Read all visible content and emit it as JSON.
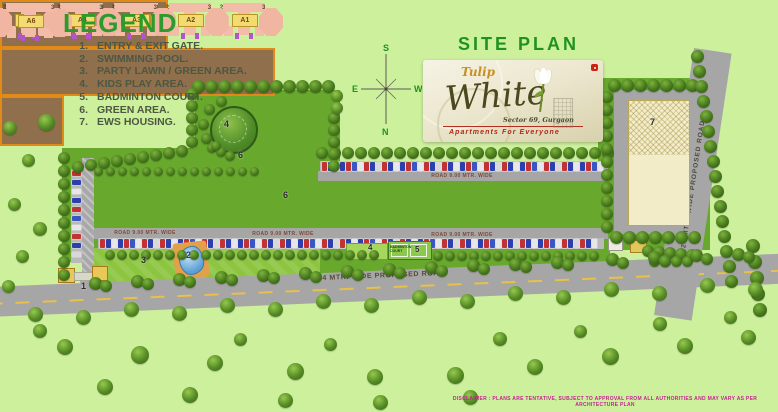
{
  "legend": {
    "title": "LEGEND",
    "items": [
      {
        "num": "1.",
        "label": "ENTRY & EXIT GATE."
      },
      {
        "num": "2.",
        "label": "SWIMMING POOL."
      },
      {
        "num": "3.",
        "label": "PARTY LAWN / GREEN AREA."
      },
      {
        "num": "4.",
        "label": "KIDS PLAY AREA."
      },
      {
        "num": "5.",
        "label": "BADMINTON COURT."
      },
      {
        "num": "6.",
        "label": "GREEN AREA."
      },
      {
        "num": "7.",
        "label": "EWS HOUSING."
      }
    ]
  },
  "header": {
    "site_plan_title": "SITE PLAN"
  },
  "compass": {
    "north": "N",
    "south": "S",
    "east": "E",
    "west": "W"
  },
  "logo": {
    "brand": "Tulip",
    "name": "White",
    "location": "Sector 69, Gurgaon",
    "tagline": "Apartments  For  Everyone"
  },
  "map": {
    "towers_left": [
      "A9",
      "A8",
      "A7"
    ],
    "towers_right": [
      "A5",
      "A4",
      "A3",
      "A2",
      "A1"
    ],
    "tower_top": [
      "A6"
    ],
    "unit_corners": [
      "2",
      "3",
      "1",
      "4"
    ],
    "road_internal_top": "ROAD 9.00 MTR. WIDE",
    "road_internal_bottom": "ROAD 9.00 MTR. WIDE",
    "road_main_bottom": "24 MTR. WIDE PROPOSED ROAD",
    "road_right": "24 MTR. WIDE PROPOSED ROAD",
    "badminton_court_label": "BADMINTON COURT",
    "markers": {
      "entry_gate": "1",
      "swimming_pool": "2",
      "party_lawn": "3",
      "kids_play_upper": "4",
      "kids_play_lower": "4",
      "badminton": "5",
      "green_upper": "6",
      "green_mid": "6",
      "ews": "7"
    }
  },
  "footer": {
    "disclaimer": "DISCLAIMER : PLANS ARE TENTATIVE, SUBJECT TO APPROVAL FROM ALL AUTHORITIES AND MAY VARY AS PER ARCHITECTURE PLAN"
  },
  "colors": {
    "background": "#cdf09d",
    "site_green": "#67a82d",
    "lawn_green": "#8cc540",
    "road_gray": "#a6a6a6",
    "block_brown": "#8f6f4c",
    "block_border_orange": "#e08a18",
    "building_pink": "#f3bca8",
    "label_yellow": "#f2dc72",
    "title_green": "#2e9a2e",
    "legend_text": "#4d5742",
    "disclaimer_magenta": "#c2248e",
    "pool_blue": "#5b9fd4",
    "car_red": "#c23232",
    "car_blue": "#2b3fae"
  }
}
